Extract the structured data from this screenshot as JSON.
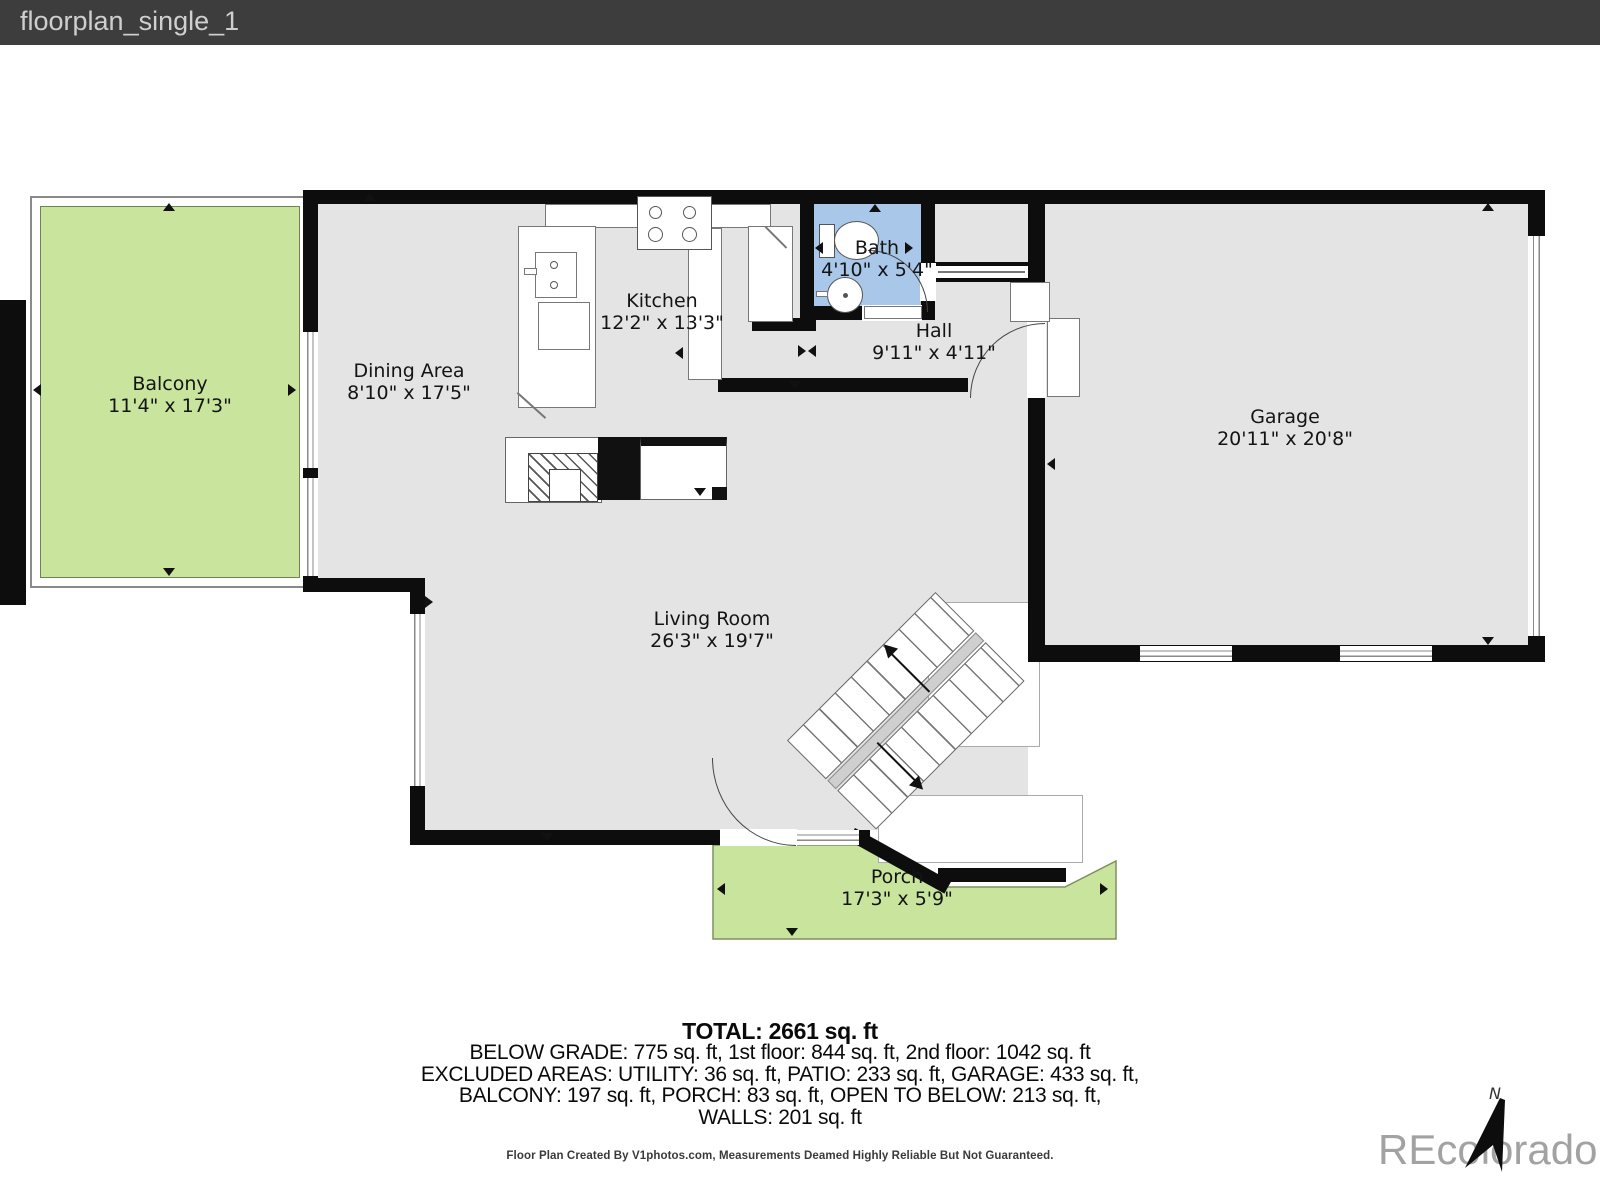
{
  "window": {
    "title": "floorplan_single_1"
  },
  "rooms": {
    "balcony": {
      "name": "Balcony",
      "dims": "11'4\" x 17'3\""
    },
    "dining": {
      "name": "Dining Area",
      "dims": "8'10\" x 17'5\""
    },
    "kitchen": {
      "name": "Kitchen",
      "dims": "12'2\" x 13'3\""
    },
    "bath": {
      "name": "Bath",
      "dims": "4'10\" x 5'4\""
    },
    "hall": {
      "name": "Hall",
      "dims": "9'11\" x 4'11\""
    },
    "garage": {
      "name": "Garage",
      "dims": "20'11\" x 20'8\""
    },
    "living": {
      "name": "Living Room",
      "dims": "26'3\" x 19'7\""
    },
    "porch": {
      "name": "Porch",
      "dims": "17'3\" x 5'9\""
    }
  },
  "summary": {
    "total": "TOTAL: 2661 sq. ft",
    "line1": "BELOW GRADE: 775 sq. ft, 1st floor: 844 sq. ft, 2nd floor: 1042 sq. ft",
    "line2": "EXCLUDED AREAS: UTILITY: 36 sq. ft, PATIO: 233 sq. ft, GARAGE: 433 sq. ft,",
    "line3": "BALCONY: 197 sq. ft, PORCH: 83 sq. ft, OPEN TO BELOW: 213 sq. ft,",
    "line4": "WALLS: 201 sq. ft"
  },
  "disclaimer": "Floor Plan Created By V1photos.com, Measurements Deamed Highly Reliable But Not Guaranteed.",
  "watermark": "REcolorado",
  "compass": {
    "label": "N"
  },
  "colors": {
    "titlebar": "#3d3d3d",
    "room_gray": "#e4e4e4",
    "outdoor_green": "#c9e49c",
    "bath_blue": "#a9c7e8",
    "wall_black": "#0d0d0d"
  }
}
